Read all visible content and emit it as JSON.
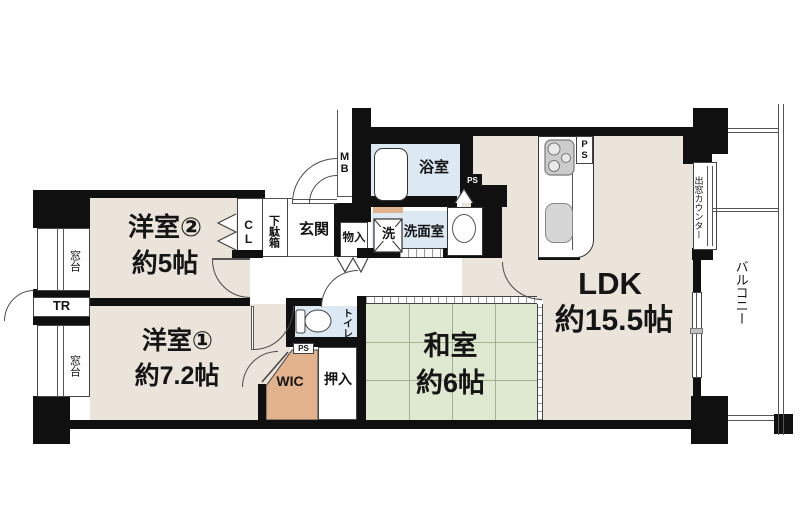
{
  "labels": {
    "room_yo2": "洋室②",
    "room_yo2_size": "約5帖",
    "room_yo1": "洋室①",
    "room_yo1_size": "約7.2帖",
    "room_washitsu": "和室",
    "room_washitsu_size": "約6帖",
    "room_ldk": "LDK",
    "room_ldk_size": "約15.5帖",
    "bath": "浴室",
    "washroom": "洗面室",
    "washer": "洗",
    "toilet": "トイレ",
    "genkan": "玄関",
    "shoe_cabinet": "下駄箱",
    "closet_cl": "CL",
    "storage_monoire": "物入",
    "oshiire": "押入",
    "wic": "WIC",
    "trunk_room": "TR",
    "meter_box": "MB",
    "pipe_space": "PS",
    "window_sill": "窓台",
    "bay_window_counter": "出窓カウンター",
    "balcony": "バルコニー"
  },
  "colors": {
    "wall": "#101010",
    "western_room_floor": "#eae4da",
    "tatami_floor": "#dfe8d0",
    "wet_area_floor": "#dce8f2",
    "storage_floor": "#e2b28c"
  }
}
